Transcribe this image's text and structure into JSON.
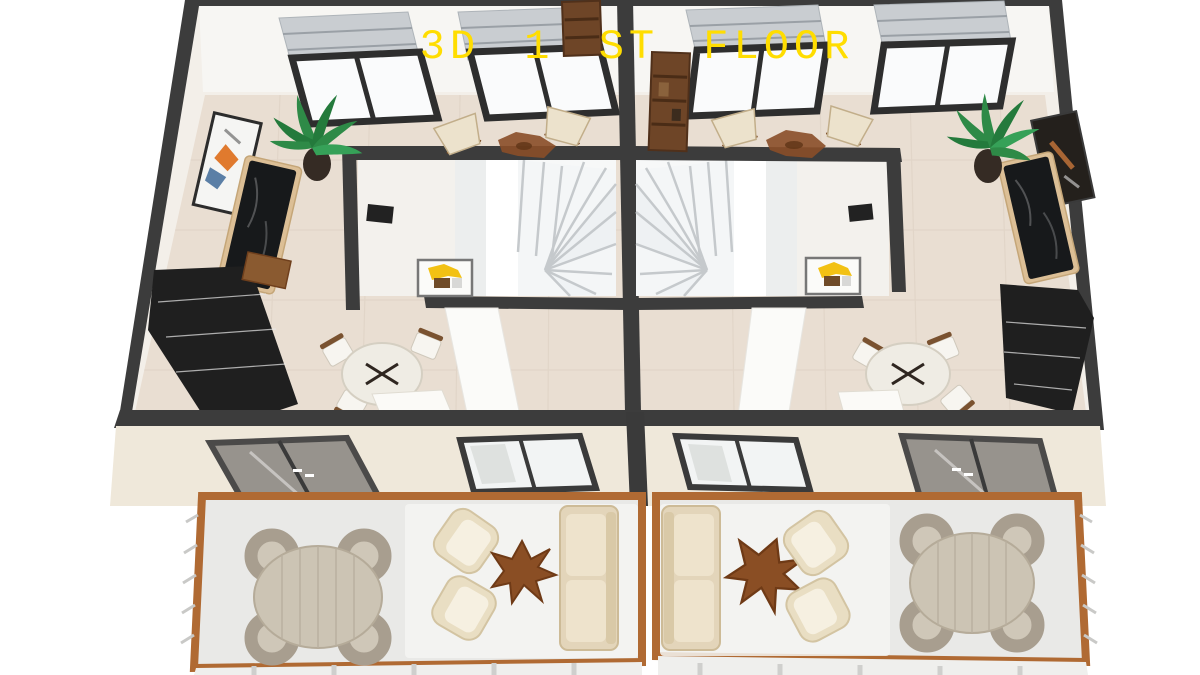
{
  "title": {
    "text": "3D 1 ST FLOOR",
    "color": "#FFDD00"
  },
  "colors": {
    "background": "#FFFFFF",
    "wall_dark": "#3C3C3C",
    "interior_wall_white": "#F6F4F0",
    "interior_floor_tile": "#E9DED2",
    "front_wall_cream": "#EFE8DA",
    "terrace_frame_wood": "#B06A33",
    "terrace_floor": "#E9E9E7",
    "kitchen_cabinet_dark": "#1F1F1F",
    "sideboard_oak": "#DCBF96",
    "marble_top_black": "#17191B",
    "stair_white": "#F7F8F8",
    "plant_green": "#2E8A47",
    "artwork_yellow": "#F2C113",
    "artwork_orange": "#E07A2E",
    "artwork_blue": "#5B7FA6",
    "sofa_beige": "#E3D5BA",
    "armchair_cream": "#E9DEC3",
    "wicker_chair_gray": "#A89E8F",
    "outdoor_table_wood": "#CCC4B4",
    "coffee_table_root_brown": "#8A4E24",
    "rug_cowhide_brown": "#8A4E28",
    "valance_gray": "#C9CDD1",
    "bookshelf_brown": "#6E4527"
  }
}
